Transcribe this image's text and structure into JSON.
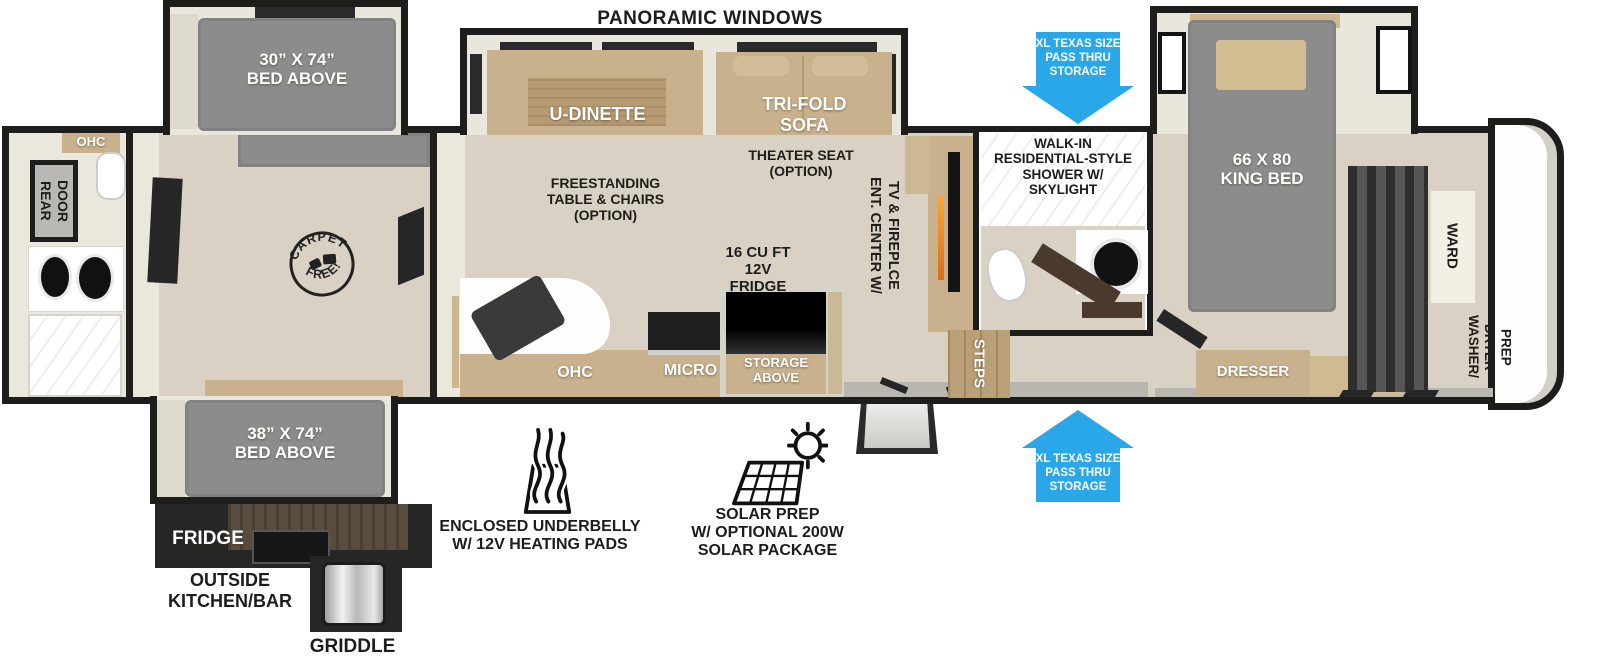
{
  "diagram": {
    "type": "rv-fifth-wheel-floorplan",
    "colors": {
      "wall": "#1d1d1b",
      "floor_wood": "#d9d1c3",
      "interior_cream": "#eae7dd",
      "bed_gray": "#8c8c8c",
      "furniture_tan": "#c8b18c",
      "accent_blue": "#29a7e8",
      "fireplace_glow": "#e8872a"
    }
  },
  "labels": {
    "panoramic_windows": "PANORAMIC WINDOWS",
    "bunk_bed_30": "30” X 74”\nBED ABOVE",
    "convertible_bed": "60” X 74”\nCONVERTABLE\nBED/SOFA",
    "carpet_top": "CARPET",
    "carpet_bottom": "FREE!",
    "ent_center_storage": "ENT. CENTER\nW/ STORAGE\nBELOW",
    "bunk_bed_38": "38” X 74”\nBED ABOVE",
    "outside_fridge": "FRIDGE",
    "outside_kitchen": "OUTSIDE\nKITCHEN/BAR",
    "griddle": "GRIDDLE",
    "rear_ohc": "OHC",
    "rear_door": "REAR\nDOOR",
    "u_dinette": "U-DINETTE",
    "freestanding_table": "FREESTANDING\nTABLE & CHAIRS\n(OPTION)",
    "tri_fold_sofa": "TRI-FOLD\nSOFA",
    "theater_seat": "THEATER SEAT\n(OPTION)",
    "ent_center_tv": "ENT. CENTER W/\nTV & FIREPLCE",
    "fridge_12v": "16 CU FT\n12V\nFRIDGE",
    "kitchen_ohc": "OHC",
    "micro": "MICRO",
    "storage_above": "STORAGE\nABOVE",
    "walk_in_shower": "WALK-IN\nRESIDENTIAL-STYLE\nSHOWER W/\nSKYLIGHT",
    "steps": "STEPS",
    "pass_thru": "XL TEXAS SIZE\nPASS THRU\nSTORAGE",
    "king_bed": "66 X 80\nKING BED",
    "dresser": "DRESSER",
    "ward": "WARD",
    "washer_dryer": "WASHER/\nDRYER\nPREP",
    "enclosed_underbelly": "ENCLOSED UNDERBELLY\nW/ 12V HEATING PADS",
    "solar_prep": "SOLAR PREP\nW/ OPTIONAL 200W\nSOLAR PACKAGE"
  }
}
